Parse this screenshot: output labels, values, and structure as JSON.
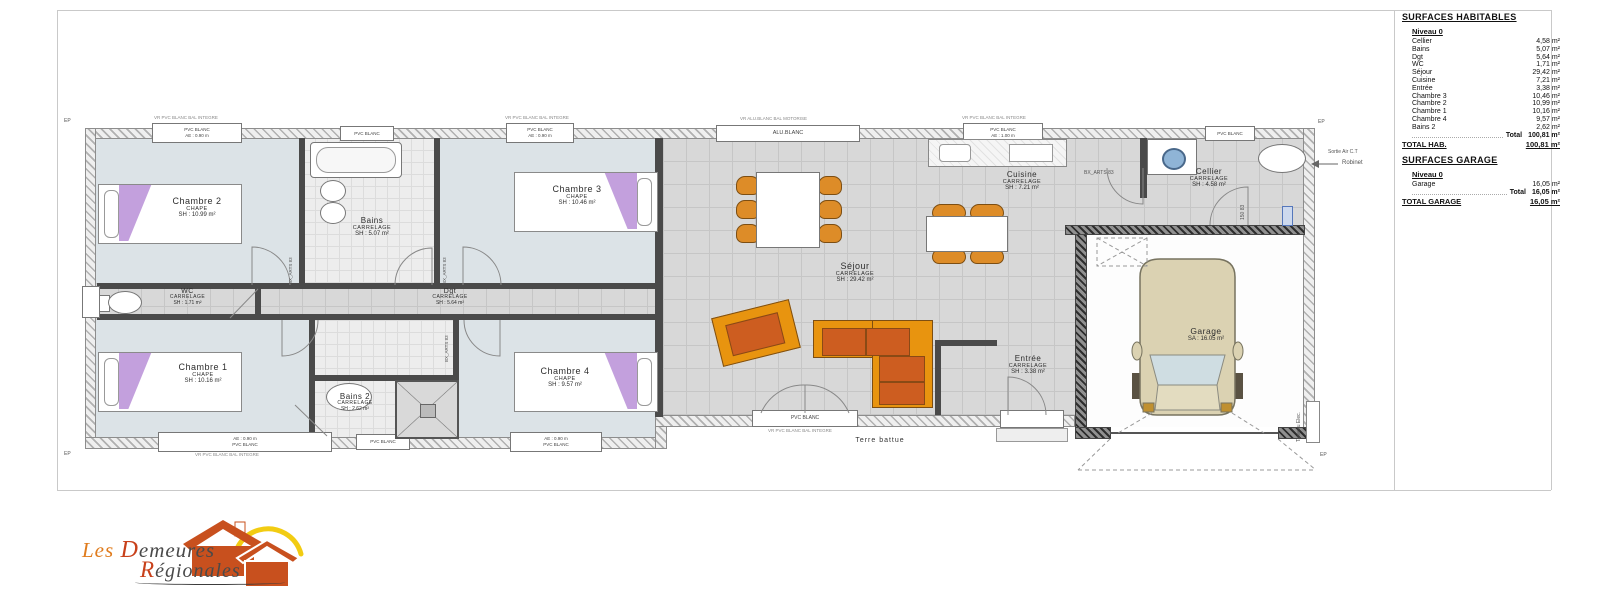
{
  "title_block": {
    "surfaces_title": "SURFACES HABITABLES",
    "niveau": "Niveau 0",
    "rows": [
      {
        "label": "Cellier",
        "value": "4,58 m²"
      },
      {
        "label": "Bains",
        "value": "5,07 m²"
      },
      {
        "label": "Dgt",
        "value": "5,64 m²"
      },
      {
        "label": "WC",
        "value": "1,71 m²"
      },
      {
        "label": "Séjour",
        "value": "29,42 m²"
      },
      {
        "label": "Cuisine",
        "value": "7,21 m²"
      },
      {
        "label": "Entrée",
        "value": "3,38 m²"
      },
      {
        "label": "Chambre 3",
        "value": "10,46 m²"
      },
      {
        "label": "Chambre 2",
        "value": "10,99 m²"
      },
      {
        "label": "Chambre 1",
        "value": "10,16 m²"
      },
      {
        "label": "Chambre 4",
        "value": "9,57 m²"
      },
      {
        "label": "Bains 2",
        "value": "2,62 m²"
      }
    ],
    "total_label": "Total",
    "total_value": "100,81 m²",
    "total_hab_label": "TOTAL HAB.",
    "total_hab_value": "100,81 m²",
    "garage_title": "SURFACES GARAGE",
    "garage_niveau": "Niveau 0",
    "garage_row": {
      "label": "Garage",
      "value": "16,05 m²"
    },
    "garage_total_label": "Total",
    "garage_total_value": "16,05 m²",
    "total_garage_label": "TOTAL GARAGE",
    "total_garage_value": "16,05 m²"
  },
  "rooms": {
    "chambre2": {
      "name": "Chambre 2",
      "material": "CHAPE",
      "area": "SH : 10.99 m²"
    },
    "bains": {
      "name": "Bains",
      "material": "CARRELAGE",
      "area": "SH : 5.07 m²"
    },
    "chambre3": {
      "name": "Chambre 3",
      "material": "CHAPE",
      "area": "SH : 10.46 m²"
    },
    "wc": {
      "name": "WC",
      "material": "CARRELAGE",
      "area": "SH : 1.71 m²"
    },
    "dgt": {
      "name": "Dgt",
      "material": "CARRELAGE",
      "area": "SH : 5.64 m²"
    },
    "chambre1": {
      "name": "Chambre 1",
      "material": "CHAPE",
      "area": "SH : 10.16 m²"
    },
    "bains2": {
      "name": "Bains 2",
      "material": "CARRELAGE",
      "area": "SH : 2.62 m²"
    },
    "chambre4": {
      "name": "Chambre 4",
      "material": "CHAPE",
      "area": "SH : 9.57 m²"
    },
    "sejour": {
      "name": "Séjour",
      "material": "CARRELAGE",
      "area": "SH : 29.42 m²"
    },
    "cuisine": {
      "name": "Cuisine",
      "material": "CARRELAGE",
      "area": "SH : 7.21 m²"
    },
    "cellier": {
      "name": "Cellier",
      "material": "CARRELAGE",
      "area": "SH : 4.58 m²"
    },
    "entree": {
      "name": "Entrée",
      "material": "CARRELAGE",
      "area": "SH : 3.38 m²"
    },
    "garage": {
      "name": "Garage",
      "area": "SA : 16.05 m²"
    }
  },
  "windows": {
    "pvc_blanc": "PVC BLANC",
    "alu_blanc": "ALU.BLANC",
    "ae_090": "AE : 0.90 m",
    "ae_100": "AE : 1.00 m",
    "vr_note_pvc": "VR PVC BLANC BAL INTEGRE",
    "vr_note_alu": "VR ALU.BLANC BAL MOTORISE"
  },
  "annotations": {
    "terre_battue": "Terre battue",
    "sortie_air": "Sortie Air C.T",
    "robinet": "Robinet",
    "tableau_elec": "Tableau Elec.",
    "ep": "EP",
    "bx_arts": "BX_ARTS 83",
    "dim_150": "150 83"
  },
  "logo": {
    "word1": "Les",
    "word2_cap": "D",
    "word2_rest": "emeures",
    "word3_cap": "R",
    "word3_rest": "égionales"
  },
  "colors": {
    "furniture_orange": "#dd8c28",
    "cushion_orange": "#cd5d20",
    "bed_purple": "#c3a0dd",
    "car_beige": "#dbd2b2",
    "drum_blue": "#8fb4d6",
    "logo_orange": "#c8501e",
    "sun_yellow": "#f2cc12"
  }
}
